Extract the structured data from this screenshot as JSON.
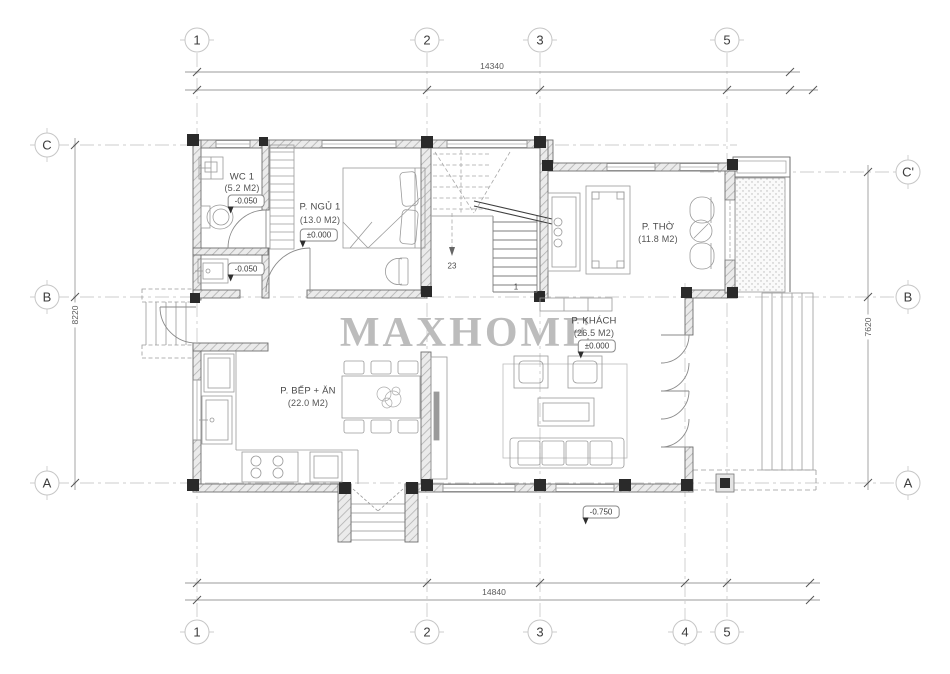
{
  "watermark": "MAXHOME",
  "grid": {
    "top": [
      "1",
      "2",
      "3",
      "5"
    ],
    "bottom": [
      "1",
      "2",
      "3",
      "4",
      "5"
    ],
    "left": [
      "C",
      "B",
      "A"
    ],
    "right": [
      "C'",
      "B",
      "A"
    ]
  },
  "dimensions": {
    "top": "14340",
    "bottom": "14840",
    "left": "8220",
    "right": "7620"
  },
  "rooms": {
    "wc": {
      "name": "WC 1",
      "area": "(5.2 M2)",
      "elevation": "-0.050"
    },
    "bedroom": {
      "name": "P. NGỦ 1",
      "area": "(13.0 M2)",
      "elevation": "±0.000"
    },
    "worship": {
      "name": "P. THỜ",
      "area": "(11.8 M2)"
    },
    "living": {
      "name": "P. KHÁCH",
      "area": "(26.5 M2)",
      "elevation": "±0.000"
    },
    "kitchen": {
      "name": "P. BẾP + ĂN",
      "area": "(22.0 M2)"
    }
  },
  "annotations": {
    "utility_elevation": "-0.050",
    "porch_elevation": "-0.750",
    "stair_steps": "23",
    "stair_start": "1"
  },
  "colors": {
    "wall_fill": "#ebebeb",
    "hatch_line": "#adadad",
    "column": "#2a2a2a",
    "furniture_line": "#9a9a9a",
    "grid_line": "#cccccc",
    "text": "#4a4a4a",
    "watermark": "#b5b5b5"
  }
}
